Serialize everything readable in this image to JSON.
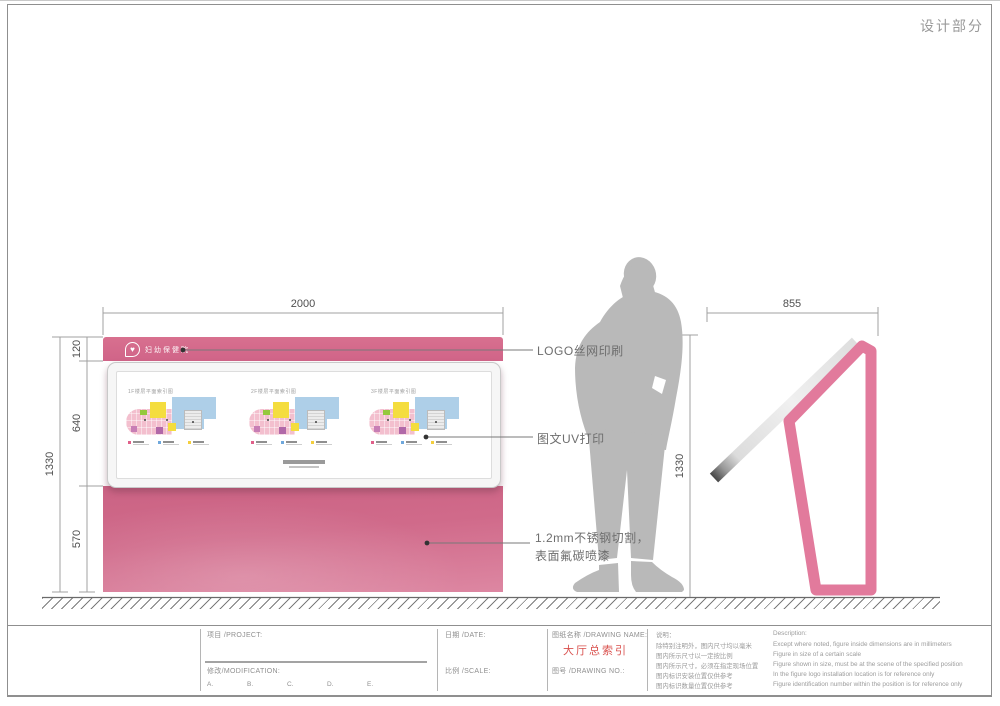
{
  "page": {
    "section_title": "设计部分"
  },
  "front_view": {
    "dims": {
      "width": "2000",
      "total_height": "1330",
      "header_height": "120",
      "panel_height": "640",
      "base_height": "570"
    },
    "logo_text": "妇幼保健院",
    "plans": [
      {
        "title": "1F楼层平面索引图"
      },
      {
        "title": "2F楼层平面索引图"
      },
      {
        "title": "3F楼层平面索引图"
      }
    ]
  },
  "side_view": {
    "dims": {
      "depth": "855",
      "height": "1330"
    }
  },
  "annotations": {
    "logo_print": "LOGO丝网印刷",
    "uv_print": "图文UV打印",
    "steel_line1": "1.2mm不锈钢切割，",
    "steel_line2": "表面氟碳喷漆"
  },
  "icons": {
    "logo_icon": "♥"
  },
  "title_block": {
    "project_label": "项目 /PROJECT:",
    "modification_label": "修改/MODIFICATION:",
    "revisions": [
      "A.",
      "B.",
      "C.",
      "D.",
      "E."
    ],
    "date_label": "日期 /DATE:",
    "scale_label": "比例 /SCALE:",
    "drawing_name_label": "图纸名称 /DRAWING NAME:",
    "drawing_name": "大厅总索引",
    "drawing_no_label": "图号 /DRAWING NO.:",
    "notes_cn_title": "说明：",
    "notes_cn": [
      "除特别注明外，图内尺寸均以毫米",
      "图内所示尺寸以一定按比例",
      "图内所示尺寸，必须在指定现场位置",
      "图内标识安装位置仅供参考",
      "图内标识数量位置仅供参考"
    ],
    "notes_en_title": "Description:",
    "notes_en": [
      "Except where noted, figure inside dimensions are in millimeters",
      "Figure in size of a certain scale",
      "Figure shown in size, must be at the scene of the specified position",
      "In the figure logo installation location is for reference only",
      "Figure identification number within the position is for reference only"
    ]
  },
  "colors": {
    "pink": "#d5698b",
    "accent_red": "#d9514e",
    "silhouette_gray": "#b9b9b9"
  }
}
